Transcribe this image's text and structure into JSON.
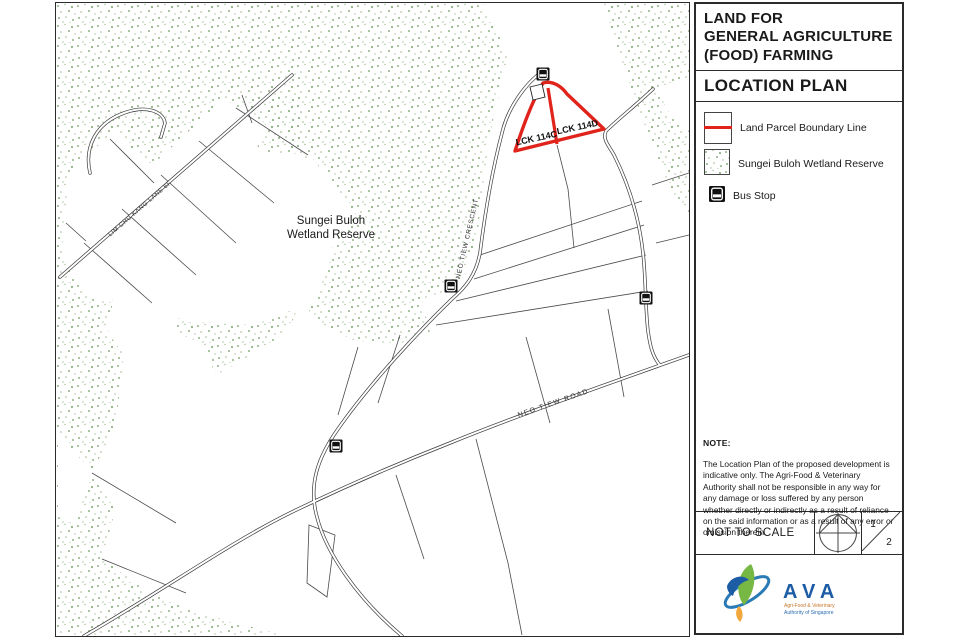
{
  "colors": {
    "boundary_red": "#e0241c",
    "stipple_green": "#8fb083",
    "line_dark": "#3c3c3c",
    "logo_blue": "#1c5ca5",
    "logo_teal": "#2a7ab5",
    "logo_green": "#76b843",
    "logo_orange": "#f2a73b"
  },
  "side_panel": {
    "title_lines": [
      "LAND FOR",
      "GENERAL AGRICULTURE",
      "(FOOD) FARMING"
    ],
    "section_title": "LOCATION PLAN",
    "legend": [
      {
        "label": "Land Parcel Boundary Line"
      },
      {
        "label": "Sungei Buloh Wetland Reserve"
      },
      {
        "label": "Bus Stop"
      }
    ],
    "note_title": "NOTE:",
    "note_body": "The Location Plan of the proposed development is indicative only. The Agri-Food & Veterinary Authority shall not be responsible in any way for any damage or loss suffered by any person whether directly or indirectly as a result of reliance on the said information or as a result of any error or omission therein.",
    "scale_label": "NOT TO SCALE",
    "page": {
      "current": "1",
      "total": "2"
    },
    "logo": {
      "text": "AVA",
      "subtext_line1": "Agri-Food & Veterinary",
      "subtext_line2": "Authority of Singapore"
    }
  },
  "map": {
    "area_label_line1": "Sungei Buloh",
    "area_label_line2": "Wetland Reserve",
    "roads": {
      "crescent": "NEO TIEW CRESCENT",
      "road": "NEO TIEW ROAD",
      "lane": "LIM CHU KANG LANE 6F"
    },
    "parcels": {
      "left": "LCK 114C",
      "right": "LCK 114D"
    }
  }
}
